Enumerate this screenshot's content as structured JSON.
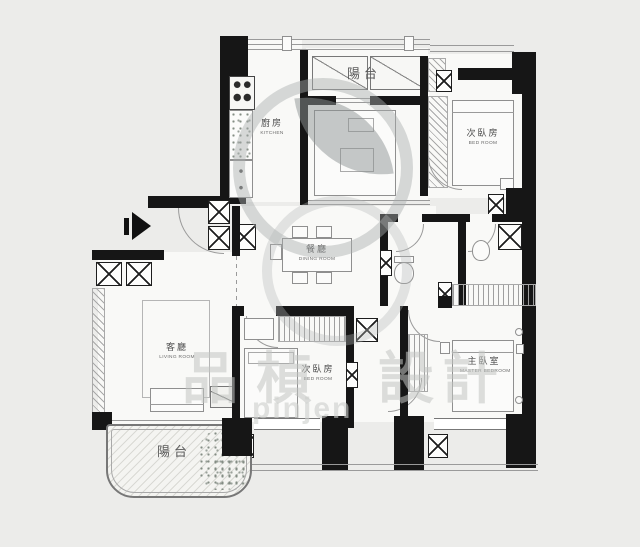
{
  "title": "apartment floor plan",
  "plan": {
    "rooms": {
      "balcony_top": {
        "zh": "陽台",
        "en": ""
      },
      "kitchen": {
        "zh": "廚房",
        "en": "KITCHEN"
      },
      "bedroom_right": {
        "zh": "次臥房",
        "en": "BED ROOM"
      },
      "dining": {
        "zh": "餐廳",
        "en": "DINING ROOM"
      },
      "living": {
        "zh": "客廳",
        "en": "LIVING ROOM"
      },
      "bedroom_middle": {
        "zh": "次臥房",
        "en": "BED ROOM"
      },
      "master_bedroom": {
        "zh": "主臥室",
        "en": "MASTER BEDROOM"
      },
      "balcony_bottom": {
        "zh": "陽台",
        "en": ""
      }
    },
    "watermark": {
      "chars": [
        "品",
        "楨",
        "設",
        "計"
      ],
      "latin": "pinjen"
    },
    "colors": {
      "background": "#ececea",
      "wall": "#161616",
      "line": "#9a9a9a",
      "watermark": "#a9adad"
    }
  }
}
